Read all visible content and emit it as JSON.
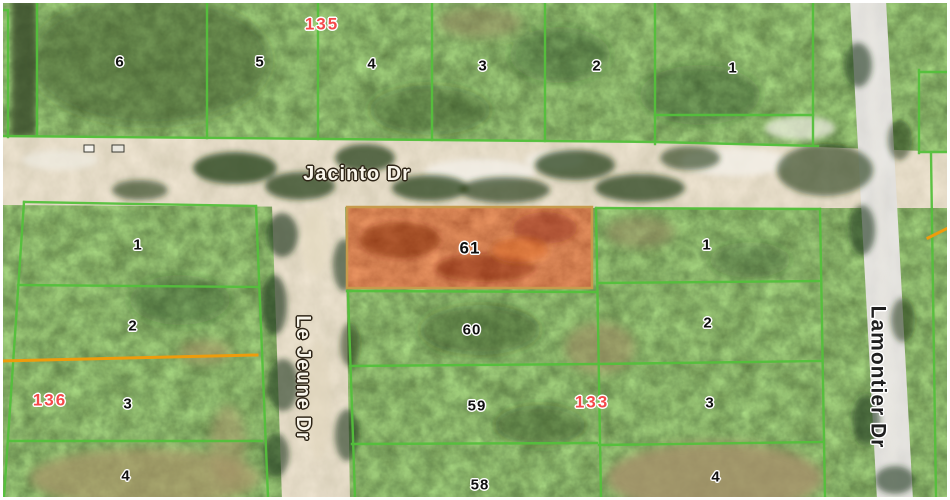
{
  "map": {
    "description": "Aerial plat map with green parcel overlay and highlighted lot",
    "streets": {
      "jacinto": "Jacinto Dr",
      "le_jeune": "Le Jeune Dr",
      "lamontier": "Lamontier Dr"
    },
    "block_numbers": {
      "north": "135",
      "west": "136",
      "east": "133"
    },
    "parcels": {
      "north_row": [
        "6",
        "5",
        "4",
        "3",
        "2",
        "1"
      ],
      "west_block": [
        "1",
        "2",
        "3",
        "4"
      ],
      "center_block": [
        "61",
        "60",
        "59",
        "58"
      ],
      "east_block": [
        "1",
        "2",
        "3",
        "4"
      ]
    },
    "highlighted_parcel": "61",
    "colors": {
      "parcel_line": "#54c03c",
      "highlight_fill": "#c03a12",
      "highlight_border": "#c79b4c",
      "lot_boundary_orange": "#ee9c0c",
      "block_number_red": "#f4494b",
      "street_label_light": "#f9f6ec",
      "street_label_dark": "#1f1f1f"
    }
  }
}
